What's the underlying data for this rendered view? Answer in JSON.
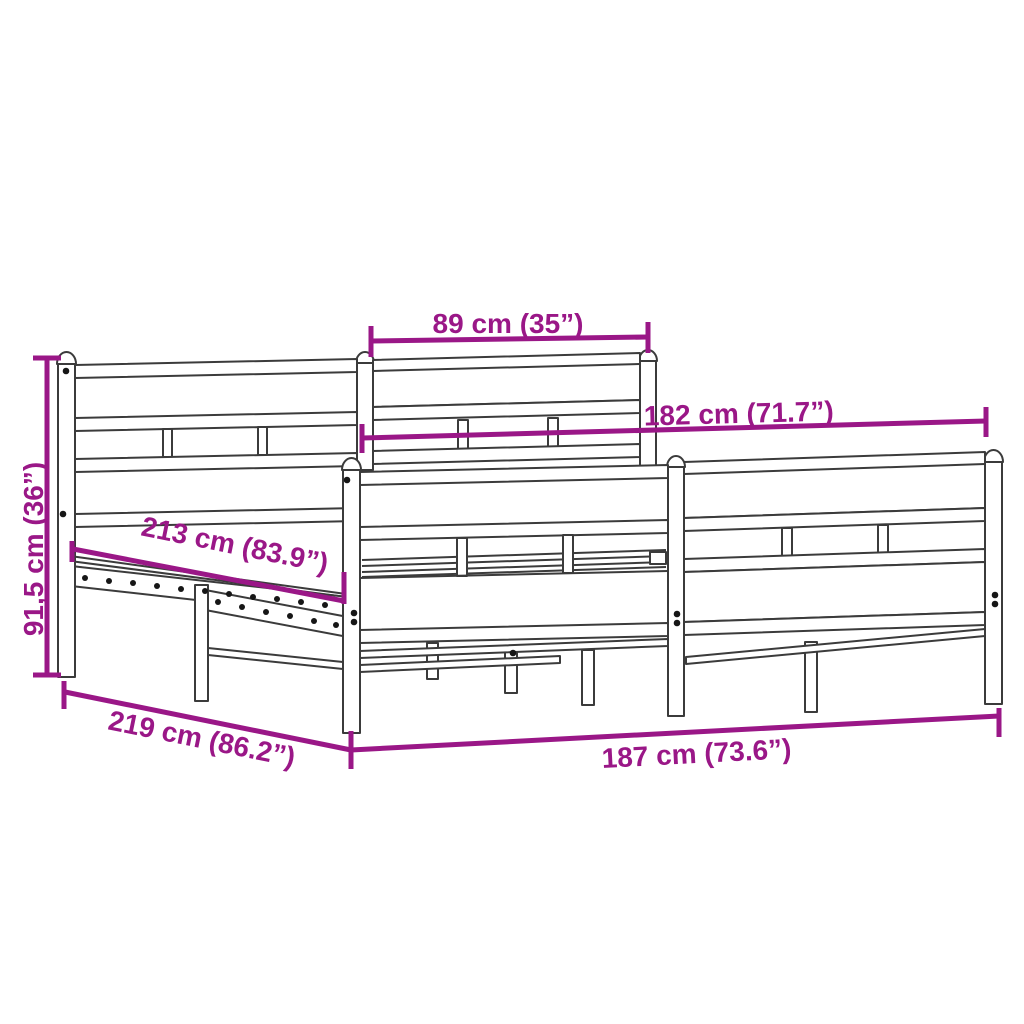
{
  "diagram": {
    "kind": "product-dimension-diagram",
    "subject": "metal bed frame with headboard and footboard and slatted base"
  },
  "colors": {
    "dimension_accent": "#9a1787",
    "drawing_line": "#3b3b3b",
    "hole_dot": "#161616",
    "background": "#ffffff"
  },
  "dimensions": {
    "headboard_top_width": {
      "label": "89 cm (35”)",
      "cm": 89,
      "inches": 35
    },
    "inner_length": {
      "label": "182 cm (71.7”)",
      "cm": 182,
      "inches": 71.7
    },
    "headboard_height": {
      "label": "91,5 cm (36”)",
      "cm": 91.5,
      "inches": 36
    },
    "slat_base_length": {
      "label": "213 cm (83.9”)",
      "cm": 213,
      "inches": 83.9
    },
    "overall_length": {
      "label": "219 cm (86.2”)",
      "cm": 219,
      "inches": 86.2
    },
    "overall_width": {
      "label": "187 cm (73.6”)",
      "cm": 187,
      "inches": 73.6
    }
  }
}
